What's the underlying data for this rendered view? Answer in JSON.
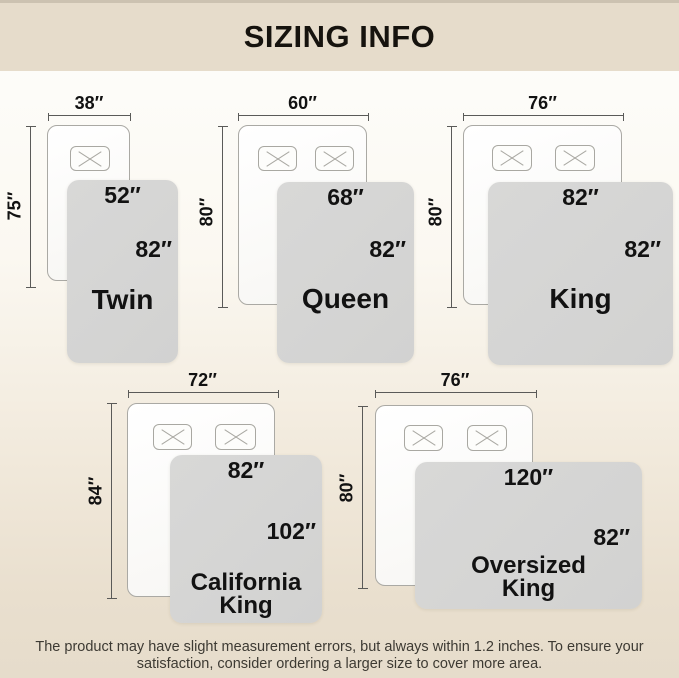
{
  "header": {
    "title": "SIZING INFO"
  },
  "sizes": [
    {
      "name": "Twin",
      "mattress_width": "38″",
      "mattress_length": "75″",
      "blanket_width": "52″",
      "blanket_length": "82″",
      "pillows": 1
    },
    {
      "name": "Queen",
      "mattress_width": "60″",
      "mattress_length": "80″",
      "blanket_width": "68″",
      "blanket_length": "82″",
      "pillows": 2
    },
    {
      "name": "King",
      "mattress_width": "76″",
      "mattress_length": "80″",
      "blanket_width": "82″",
      "blanket_length": "82″",
      "pillows": 2
    },
    {
      "name": "California King",
      "name_lines": [
        "California",
        "King"
      ],
      "mattress_width": "72″",
      "mattress_length": "84″",
      "blanket_width": "82″",
      "blanket_length": "102″",
      "pillows": 2
    },
    {
      "name": "Oversized King",
      "name_lines": [
        "Oversized",
        "King"
      ],
      "mattress_width": "76″",
      "mattress_length": "80″",
      "blanket_width": "120″",
      "blanket_length": "82″",
      "pillows": 2
    }
  ],
  "footer": {
    "note_line1": "The product may have slight measurement errors, but always within 1.2 inches. To ensure your",
    "note_line2": "satisfaction, consider ordering a larger size to cover more area."
  },
  "colors": {
    "header_band": "#e6dccb",
    "blanket": "#d3d3d2",
    "mattress": "#fbfaf8",
    "dimension_line": "#5a5a58",
    "text": "#121212"
  }
}
